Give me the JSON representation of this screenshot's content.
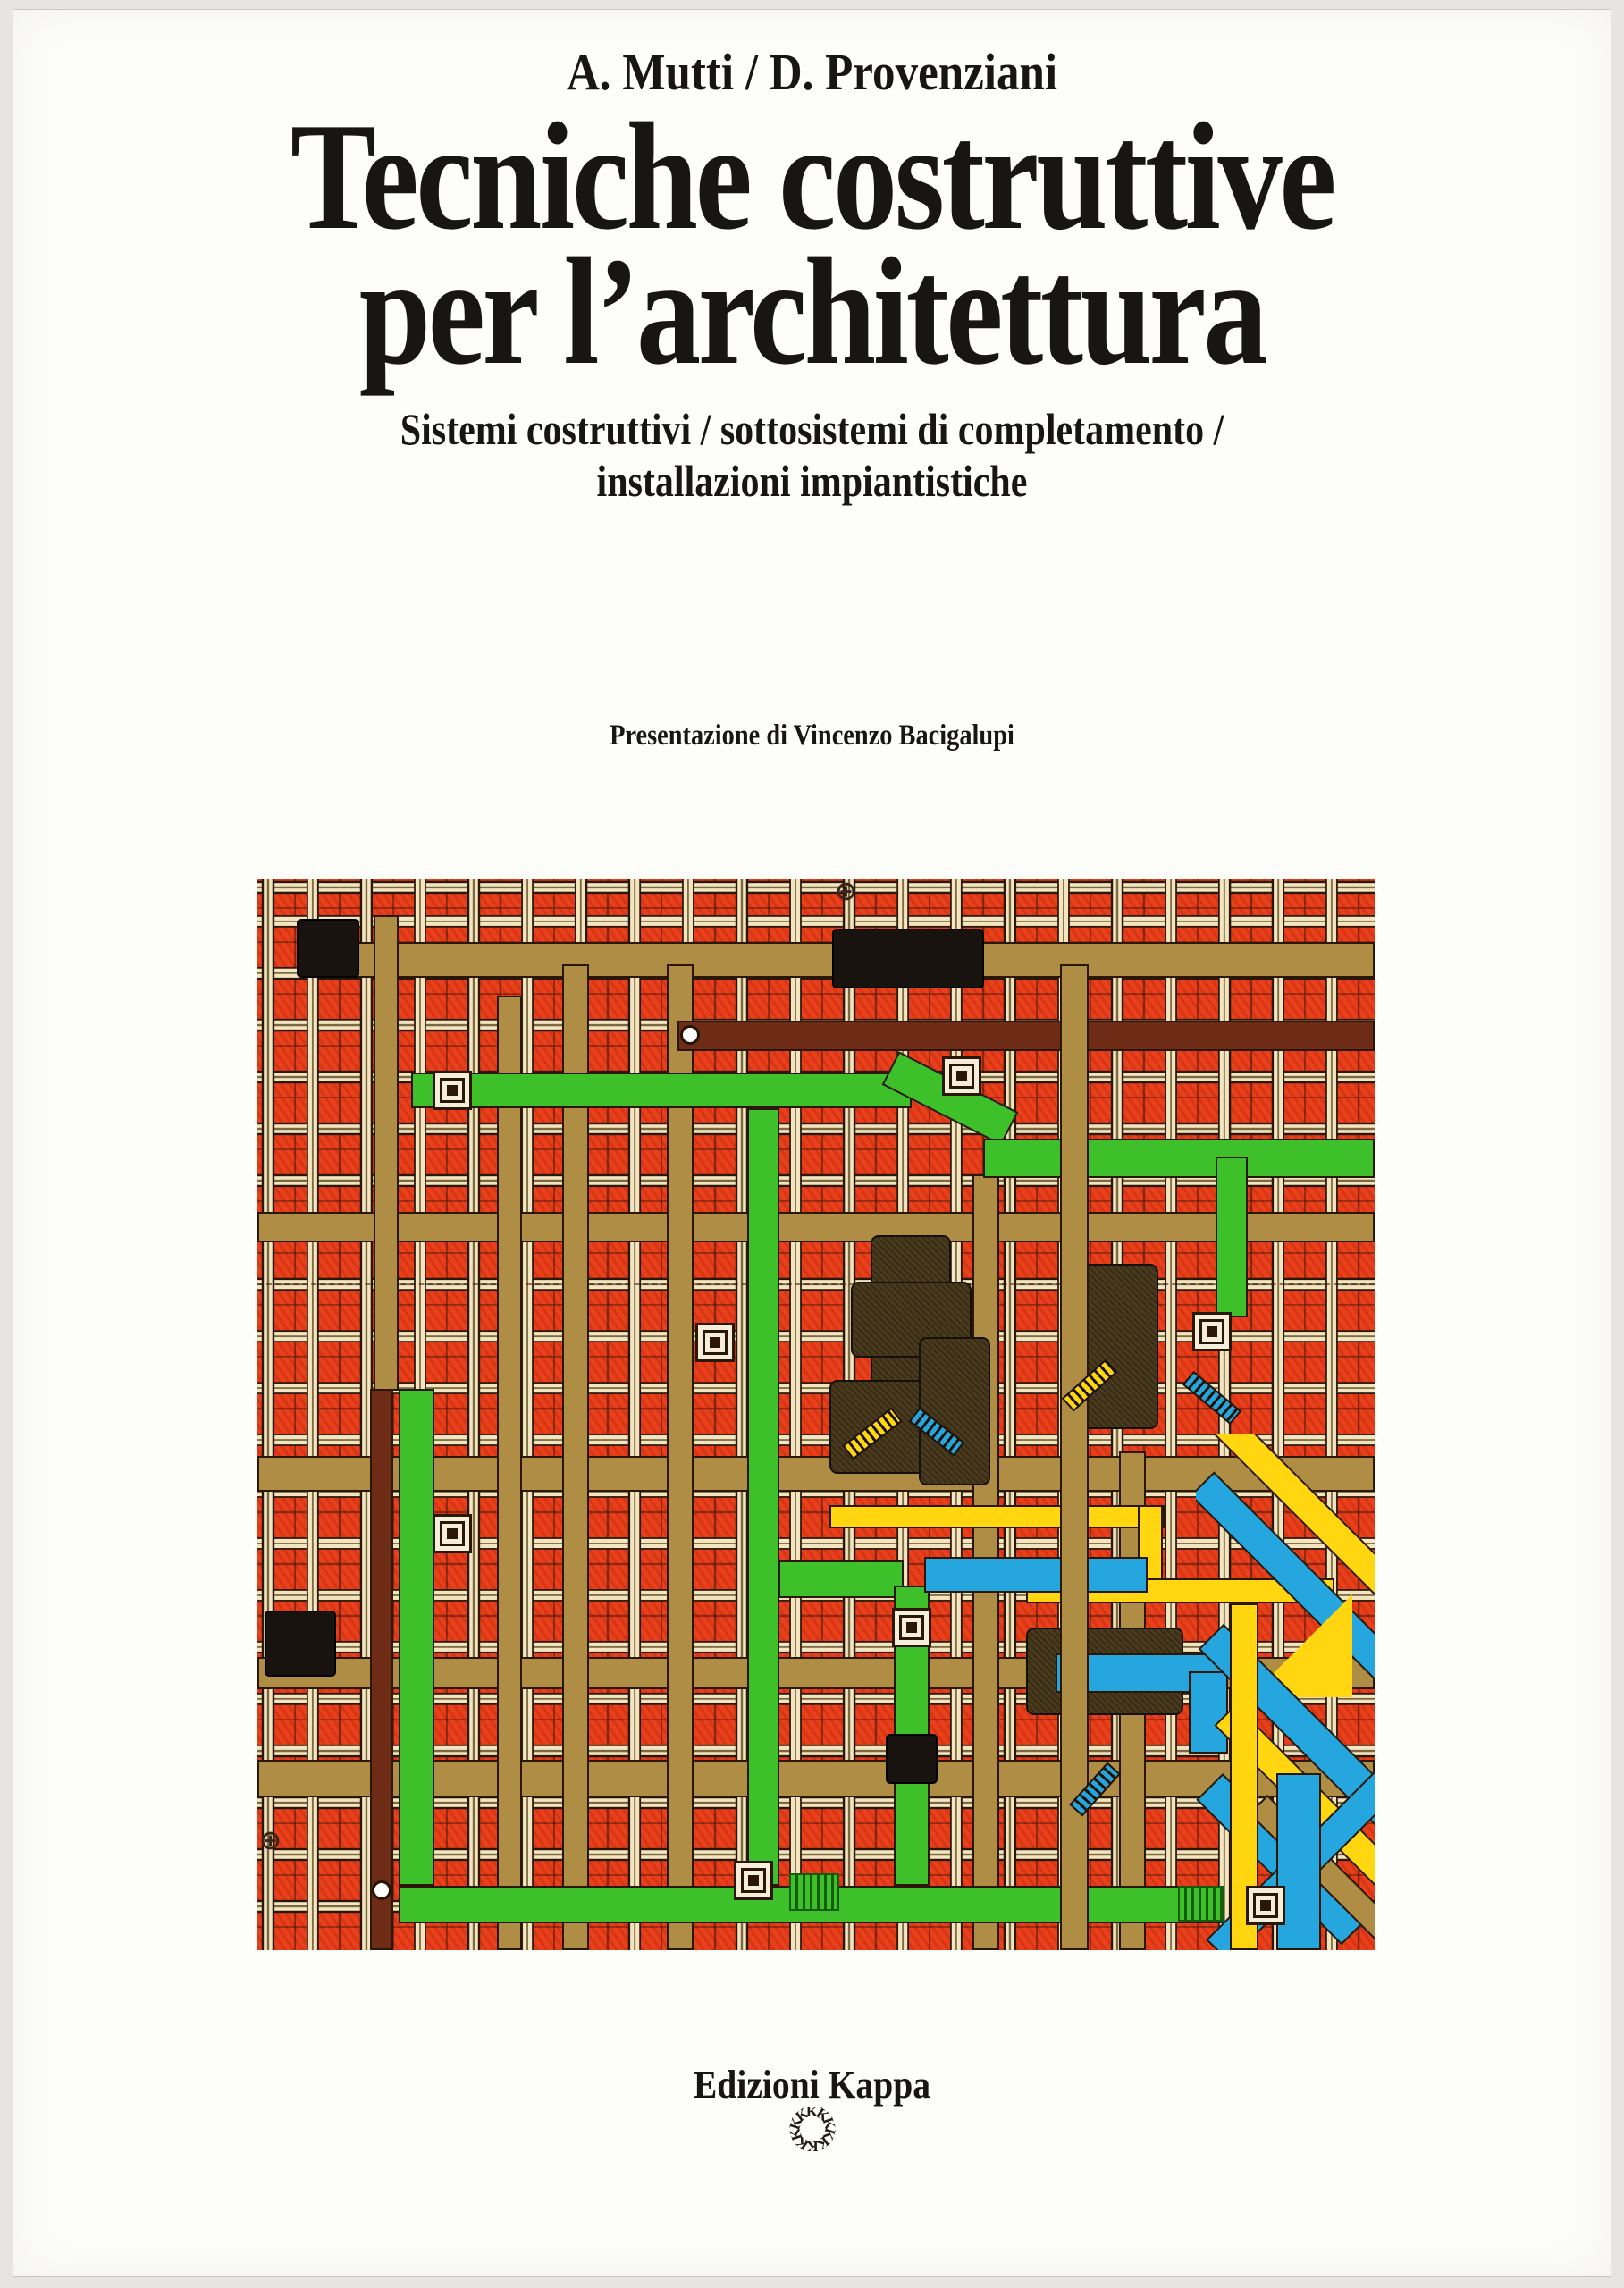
{
  "cover": {
    "author": "A. Mutti / D. Provenziani",
    "title": {
      "line1": "Tecniche costruttive",
      "line2": "per l’architettura"
    },
    "subtitle": {
      "line1": "Sistemi costruttivi / sottosistemi di completamento /",
      "line2": "installazioni impiantistiche"
    },
    "presentation": "Presentazione di Vincenzo Bacigalupi",
    "publisher": {
      "name": "Edizioni Kappa",
      "logo_letter": "K"
    }
  },
  "illustration": {
    "palette": {
      "red": "#e93f1b",
      "hatch": "#c23210",
      "cream": "#f2e5c0",
      "line": "#2a1708",
      "olive": "#b08d45",
      "green": "#3ec02b",
      "maroon": "#6e2b16",
      "equip": "#4a3a1e",
      "yellow": "#ffd60f",
      "blue": "#25a6de",
      "black": "#191310",
      "paper": "#fdfdfa",
      "ink": "#181614",
      "scanbg": "#e7e5e1",
      "edge": "#c9c6c0"
    }
  }
}
